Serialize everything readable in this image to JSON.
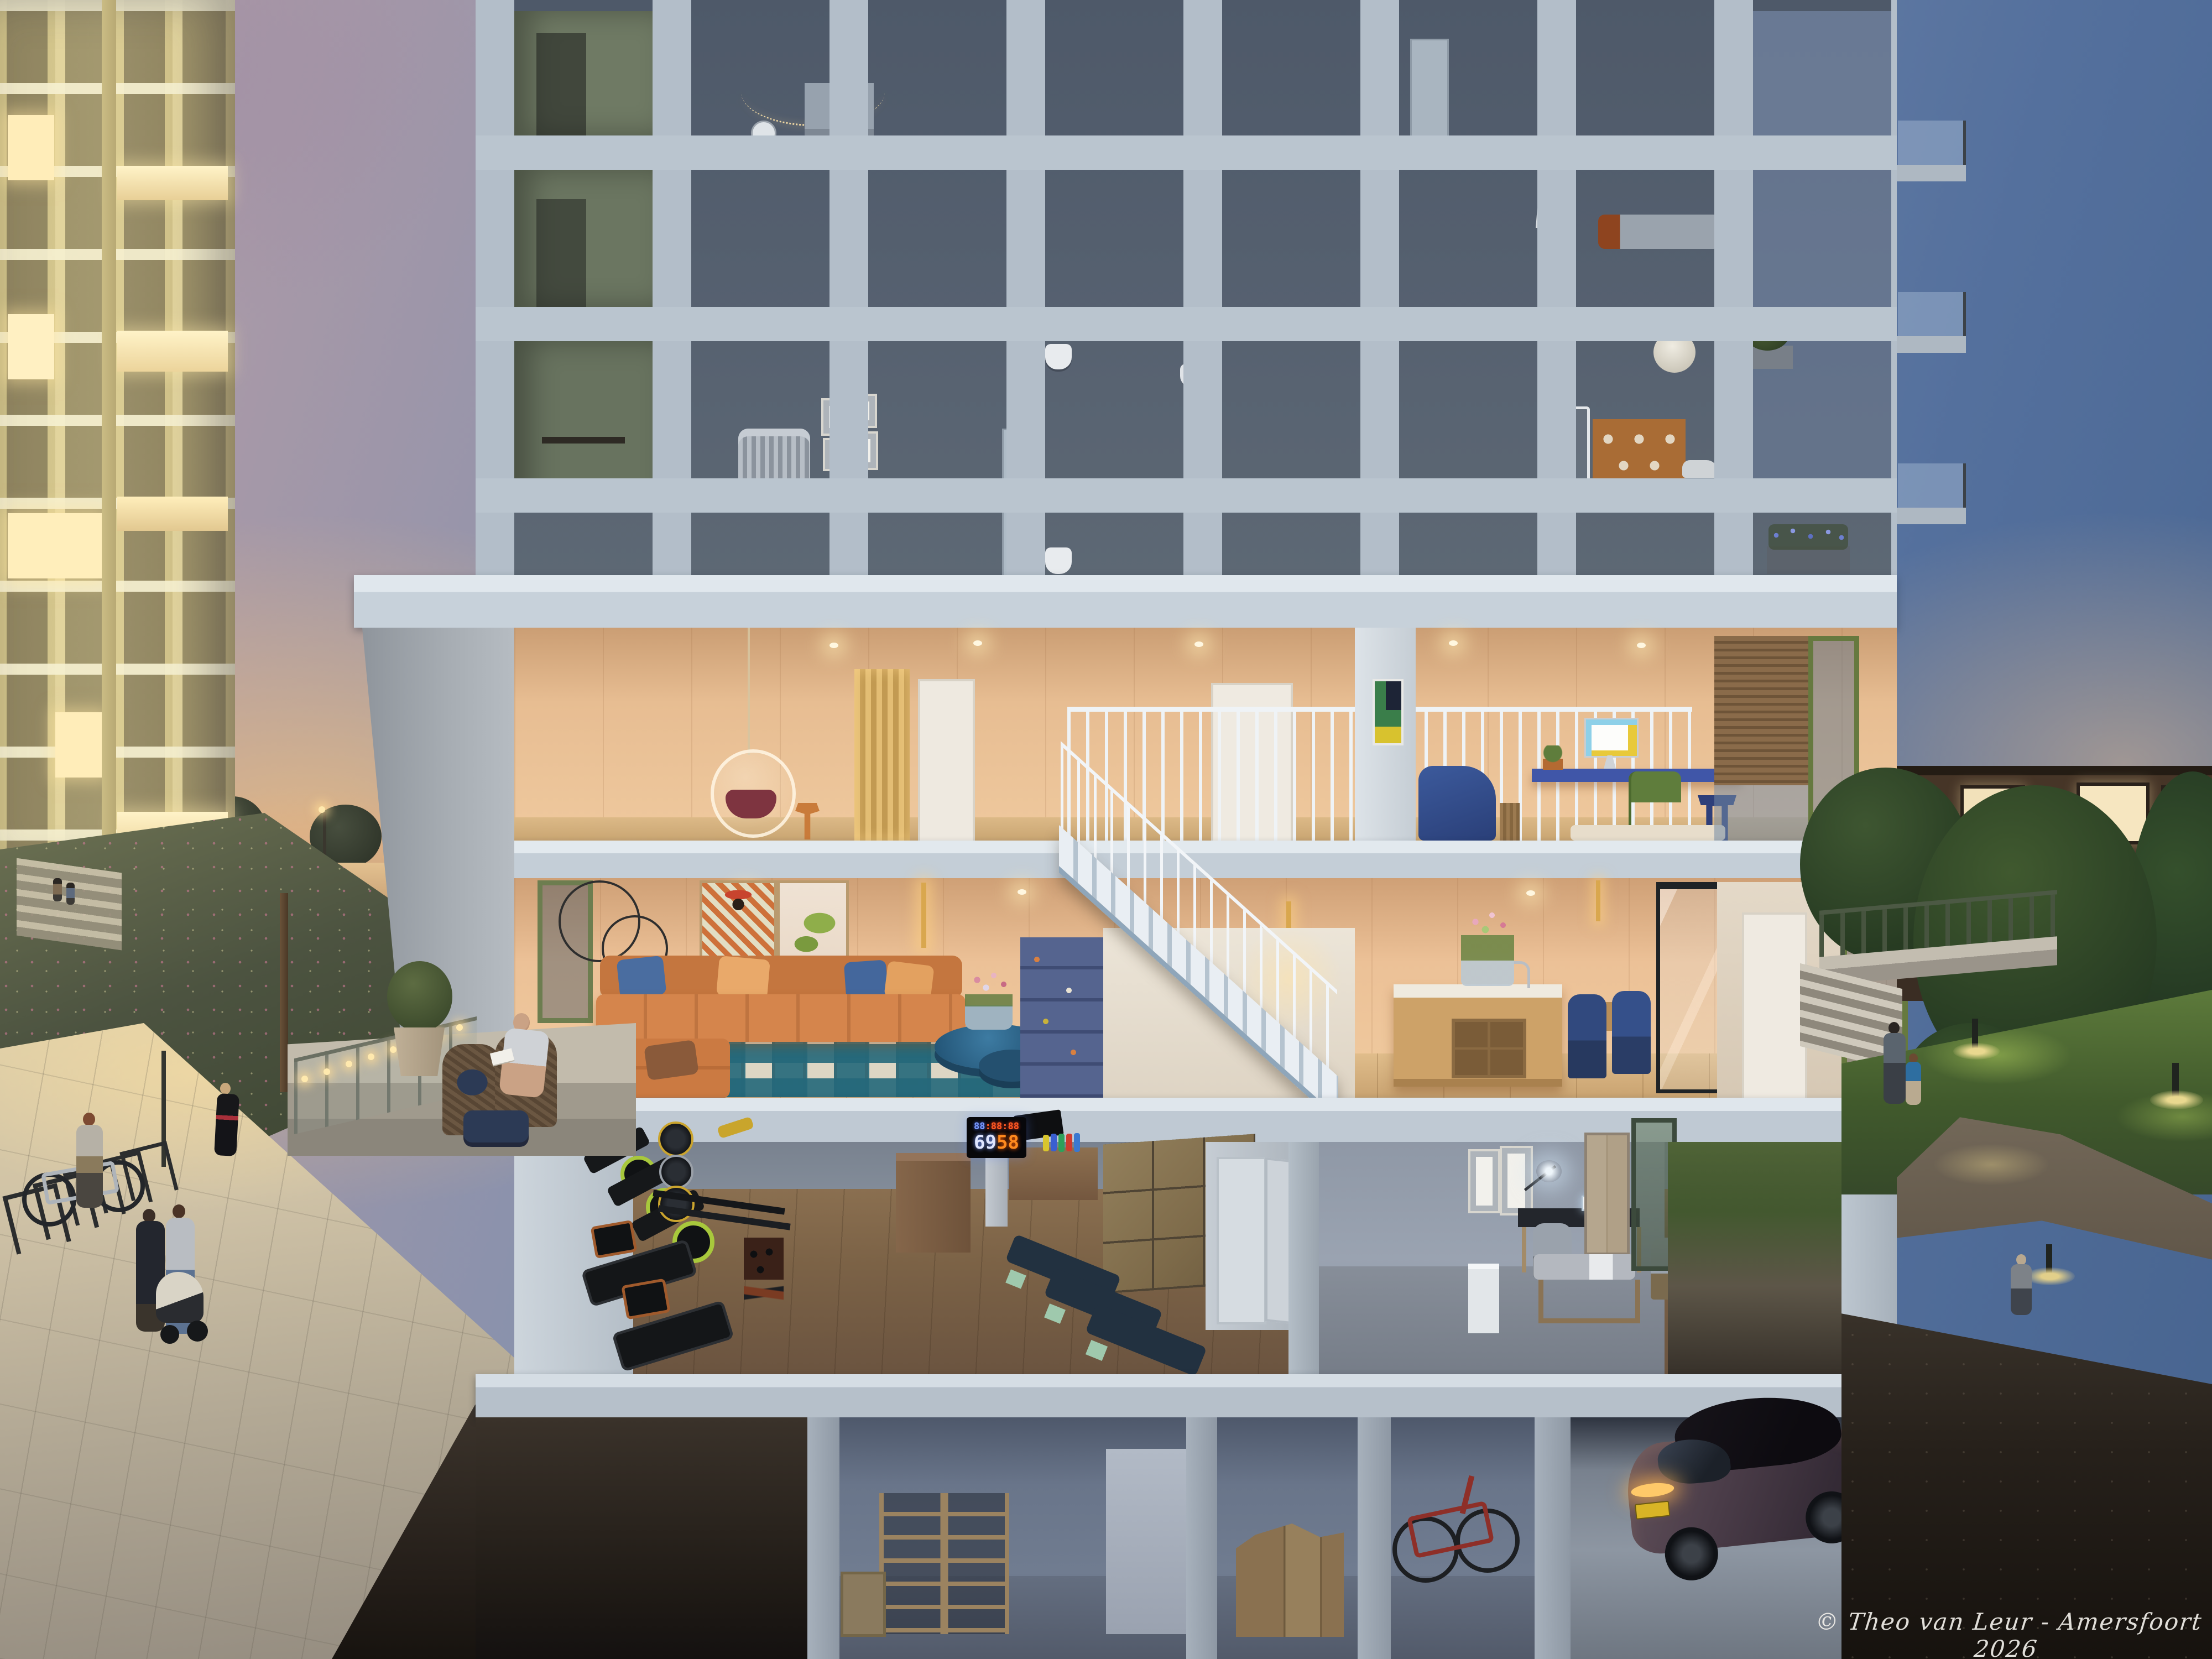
{
  "watermark": {
    "text": "© Theo van Leur - Amersfoort 2026"
  },
  "gym_display": {
    "timer_blue": "88",
    "timer_red": ":88:88",
    "count_main": "69",
    "count_accent": "58"
  },
  "palette": {
    "sky_dusk_blue": "#4c6a99",
    "sky_warm": "#e6c29a",
    "concrete_frame": "#bac5cf",
    "interior_peach": "#ecc197",
    "warm_wood_floor": "#d9b582",
    "sofa_orange": "#d5854c",
    "rug_teal": "#2e6b7a",
    "accent_green": "#77904c",
    "navy_blue": "#31497e",
    "tower_cream": "#d8c98f",
    "led_blue": "#7a9bff",
    "led_red": "#ff4a1a",
    "gym_wood": "#7c6347",
    "soil_brown": "#2e2822",
    "car_plum": "#473a45",
    "license_plate_yellow": "#d8b426"
  }
}
